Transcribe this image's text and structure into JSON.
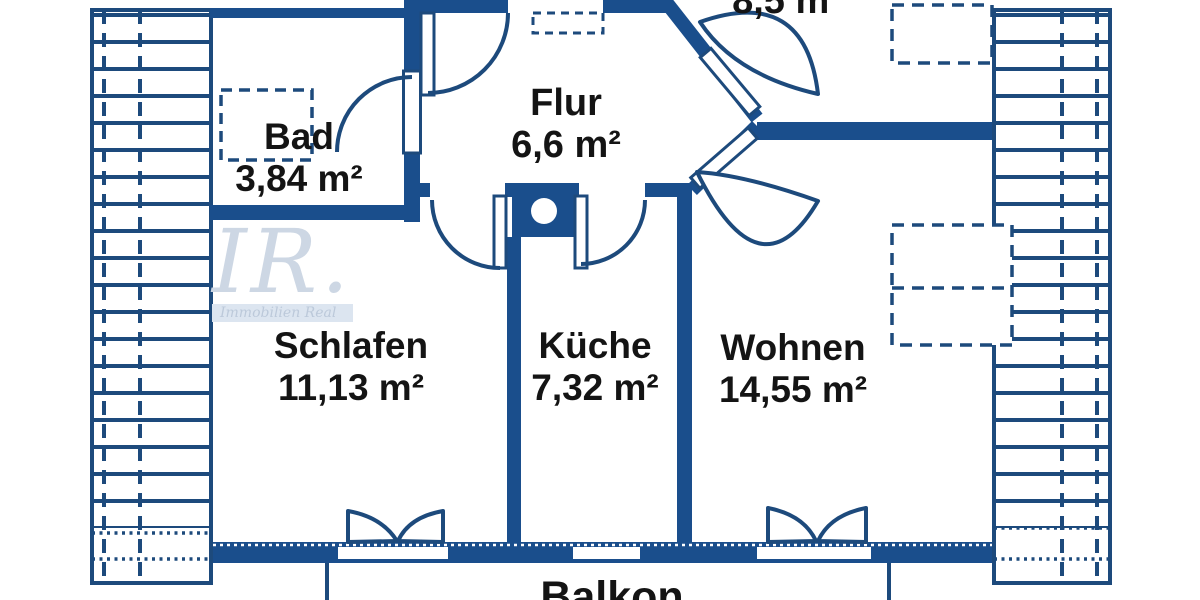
{
  "plan": {
    "watermark": {
      "initials": "IR.",
      "subtitle": "Immobilien Real"
    },
    "rooms": [
      {
        "id": "bad",
        "name": "Bad",
        "area": "3,84 m²"
      },
      {
        "id": "flur",
        "name": "Flur",
        "area": "6,6 m²"
      },
      {
        "id": "schlafen",
        "name": "Schlafen",
        "area": "11,13 m²"
      },
      {
        "id": "kueche",
        "name": "Küche",
        "area": "7,32 m²"
      },
      {
        "id": "wohnen",
        "name": "Wohnen",
        "area": "14,55 m²"
      },
      {
        "id": "zimmer-oben",
        "name": "",
        "area": "8,5 m²"
      },
      {
        "id": "balkon",
        "name": "Balkon",
        "area": ""
      }
    ],
    "colors": {
      "wall": "#1a4e8c",
      "line": "#1d4a7c",
      "text": "#141414",
      "watermark": "#cdd7e4",
      "background": "#ffffff"
    }
  }
}
